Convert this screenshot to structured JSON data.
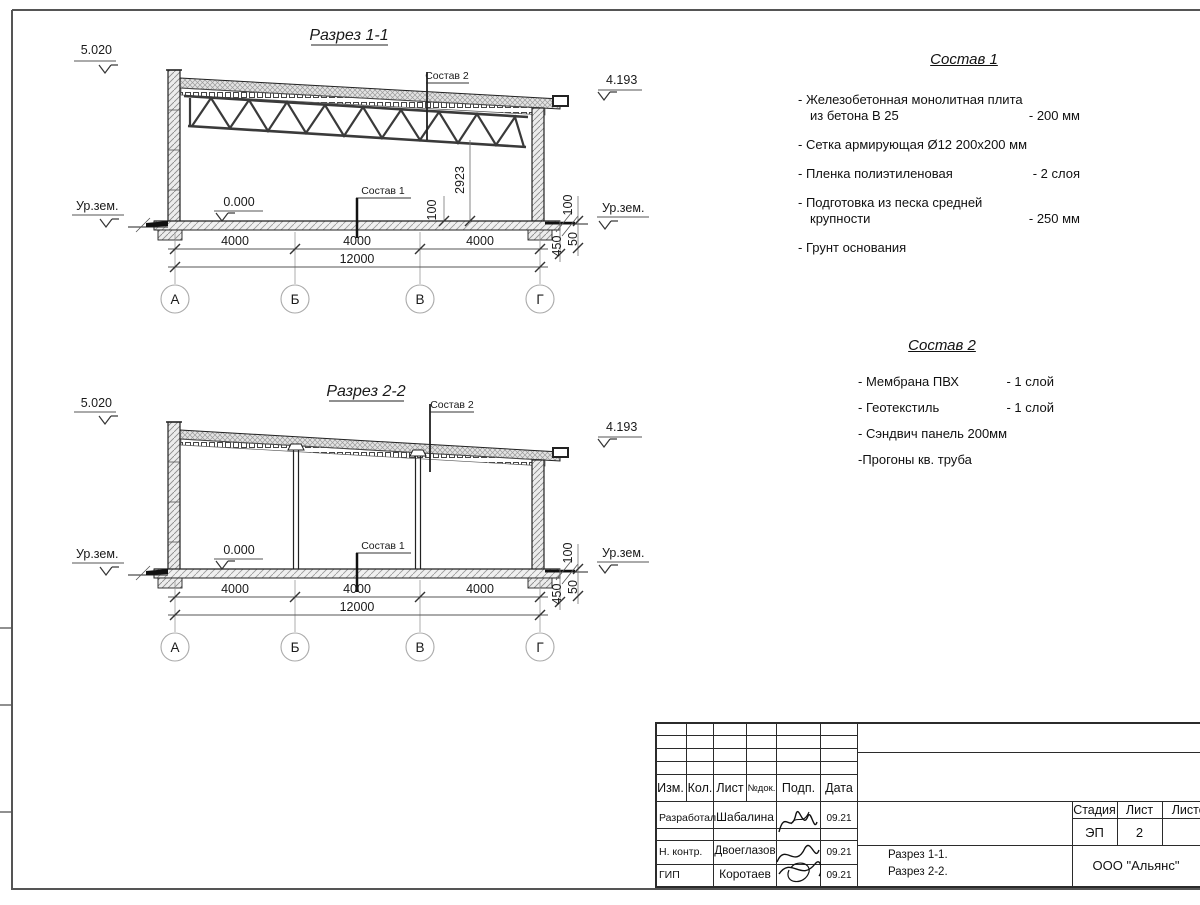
{
  "drawing": {
    "section1": {
      "title": "Разрез 1-1",
      "elev_top_left": "5.020",
      "elev_top_right": "4.193",
      "elev_zero": "0.000",
      "ground_label_left": "Ур.зем.",
      "ground_label_right": "Ур.зем.",
      "leader_top": "Состав 2",
      "leader_floor": "Состав 1",
      "dim_height": "2923",
      "dim_100_inner": "100",
      "dim_100_right": "100",
      "dim_450": "450",
      "dim_50": "50",
      "dims_span": [
        "4000",
        "4000",
        "4000"
      ],
      "dim_total": "12000",
      "axes": [
        "А",
        "Б",
        "В",
        "Г"
      ]
    },
    "section2": {
      "title": "Разрез 2-2",
      "elev_top_left": "5.020",
      "elev_top_right": "4.193",
      "elev_zero": "0.000",
      "ground_label_left": "Ур.зем.",
      "ground_label_right": "Ур.зем.",
      "leader_top": "Состав 2",
      "leader_floor": "Состав 1",
      "dim_100_right": "100",
      "dim_450": "450",
      "dim_50": "50",
      "dims_span": [
        "4000",
        "4000",
        "4000"
      ],
      "dim_total": "12000",
      "axes": [
        "А",
        "Б",
        "В",
        "Г"
      ]
    }
  },
  "notes1": {
    "title": "Состав 1",
    "items": [
      {
        "text": "- Железобетонная  монолитная плита",
        "text2": "из бетона В 25",
        "value": "- 200 мм"
      },
      {
        "text": "- Сетка армирующая Ø12 200х200 мм",
        "text2": "",
        "value": ""
      },
      {
        "text": "- Пленка полиэтиленовая",
        "text2": "",
        "value": "- 2 слоя"
      },
      {
        "text": "- Подготовка из песка средней",
        "text2": "крупности",
        "value": "- 250 мм"
      },
      {
        "text": "- Грунт основания",
        "text2": "",
        "value": ""
      }
    ]
  },
  "notes2": {
    "title": "Состав 2",
    "items": [
      {
        "text": "- Мембрана ПВХ",
        "value": "- 1 слой"
      },
      {
        "text": "- Геотекстиль",
        "value": "- 1 слой"
      },
      {
        "text": "- Сэндвич панель 200мм",
        "value": ""
      },
      {
        "text": "-Прогоны кв. труба",
        "value": ""
      }
    ]
  },
  "titleblock": {
    "header": {
      "izm": "Изм.",
      "kol": "Кол.",
      "list": "Лист",
      "ndok": "№док.",
      "podp": "Подп.",
      "data": "Дата"
    },
    "rows": [
      {
        "role": "Разработал",
        "name": "Шабалина",
        "date": "09.21"
      },
      {
        "role": "Н. контр.",
        "name": "Двоеглазов",
        "date": "09.21"
      },
      {
        "role": "ГИП",
        "name": "Коротаев",
        "date": "09.21"
      }
    ],
    "stage_label": "Стадия",
    "list_label": "Лист",
    "listov_label": "Листов",
    "stage": "ЭП",
    "list_num": "2",
    "doc1": "Разрез 1-1.",
    "doc2": "Разрез 2-2.",
    "company": "ООО \"Альянс\""
  }
}
